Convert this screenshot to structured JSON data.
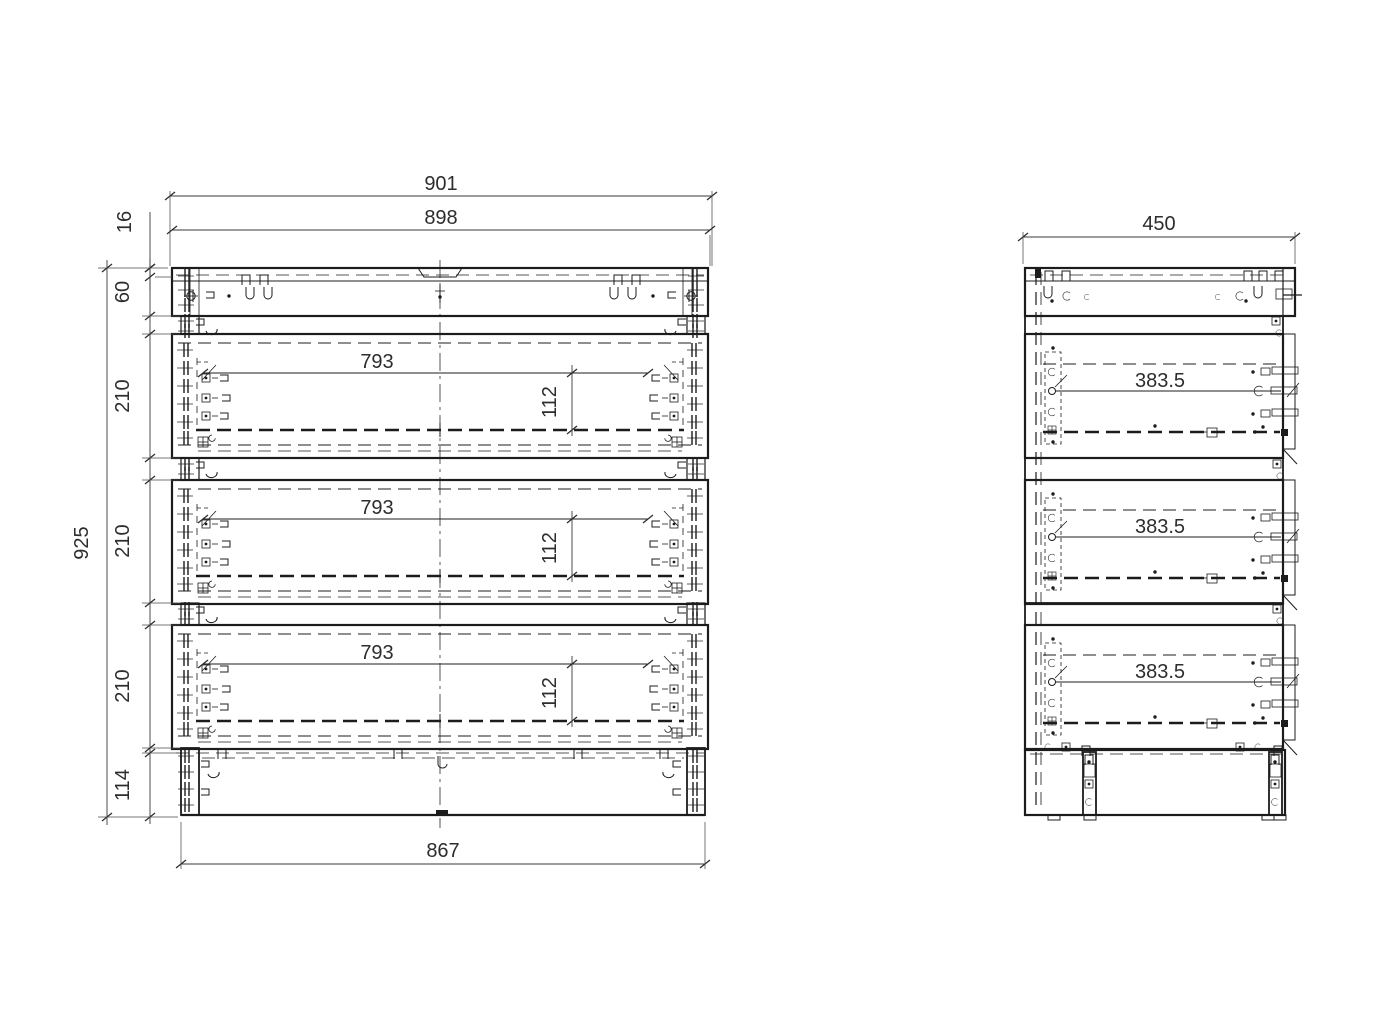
{
  "drawing": {
    "colors": {
      "line": "#1c1c1c",
      "dim_text": "#2d2d2d",
      "background": "#ffffff"
    },
    "front_view": {
      "overall_width": "901",
      "carcass_width": "898",
      "top_thickness": "16",
      "top_rail_height": "60",
      "drawer_heights": [
        "210",
        "210",
        "210"
      ],
      "base_height": "114",
      "overall_height": "925",
      "base_width": "867",
      "drawer_inner_widths": [
        "793",
        "793",
        "793"
      ],
      "drawer_inner_heights": [
        "112",
        "112",
        "112"
      ]
    },
    "side_view": {
      "depth": "450",
      "drawer_inner_depths": [
        "383.5",
        "383.5",
        "383.5"
      ]
    }
  }
}
